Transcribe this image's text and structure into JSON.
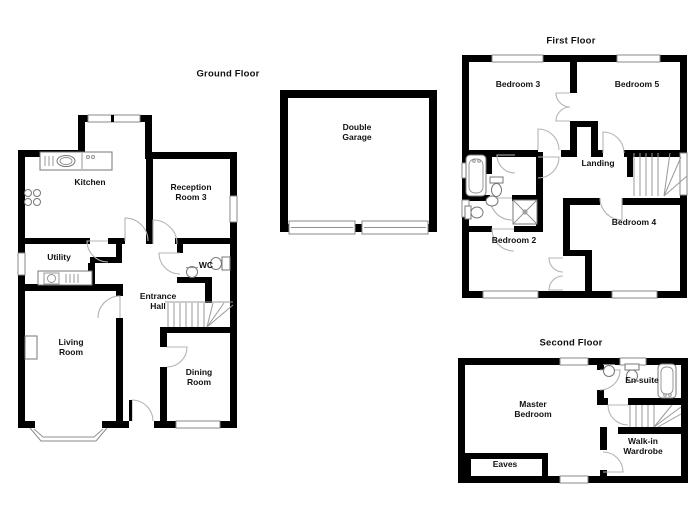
{
  "floors": {
    "ground": {
      "title": "Ground Floor",
      "rooms": {
        "kitchen": "Kitchen",
        "reception3": "Reception\nRoom 3",
        "utility": "Utility",
        "wc": "WC",
        "entrance_hall": "Entrance\nHall",
        "living": "Living\nRoom",
        "dining": "Dining\nRoom"
      }
    },
    "garage": {
      "rooms": {
        "double_garage": "Double\nGarage"
      }
    },
    "first": {
      "title": "First Floor",
      "rooms": {
        "bedroom3": "Bedroom 3",
        "bedroom5": "Bedroom 5",
        "landing": "Landing",
        "bedroom2": "Bedroom 2",
        "bedroom4": "Bedroom 4"
      }
    },
    "second": {
      "title": "Second Floor",
      "rooms": {
        "master": "Master\nBedroom",
        "ensuite": "En-suite",
        "wardrobe": "Walk-in\nWardrobe",
        "eaves": "Eaves"
      }
    }
  },
  "colors": {
    "wall": "#000000",
    "background": "#ffffff",
    "door_arc": "#b4b4b4",
    "window_frame": "#8a8a8a",
    "fixture": "#777777"
  }
}
